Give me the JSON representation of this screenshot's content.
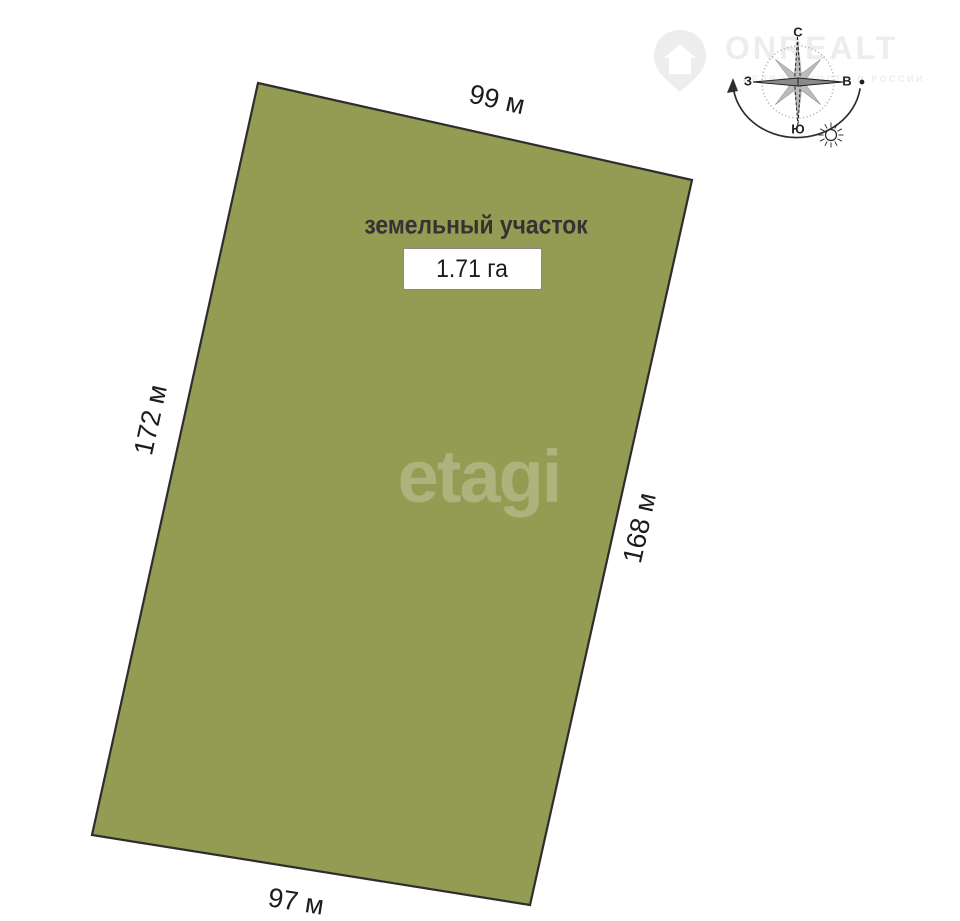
{
  "page": {
    "background": "#ffffff"
  },
  "plot": {
    "label": "земельный участок",
    "area_value": "1.71 га",
    "fill_color": "#949B53",
    "border_color": "#2d2d2d",
    "dimensions": {
      "top": "99 м",
      "left": "172 м",
      "right": "168 м",
      "bottom": "97 м"
    }
  },
  "compass": {
    "north_label": "С",
    "south_label": "Ю",
    "west_label": "З",
    "east_label": "В"
  },
  "watermarks": {
    "listing_brand": "ONREALT",
    "listing_tagline": "НЕДВИЖИМОСТЬ В РОССИИ",
    "agency_brand": "etagi"
  }
}
